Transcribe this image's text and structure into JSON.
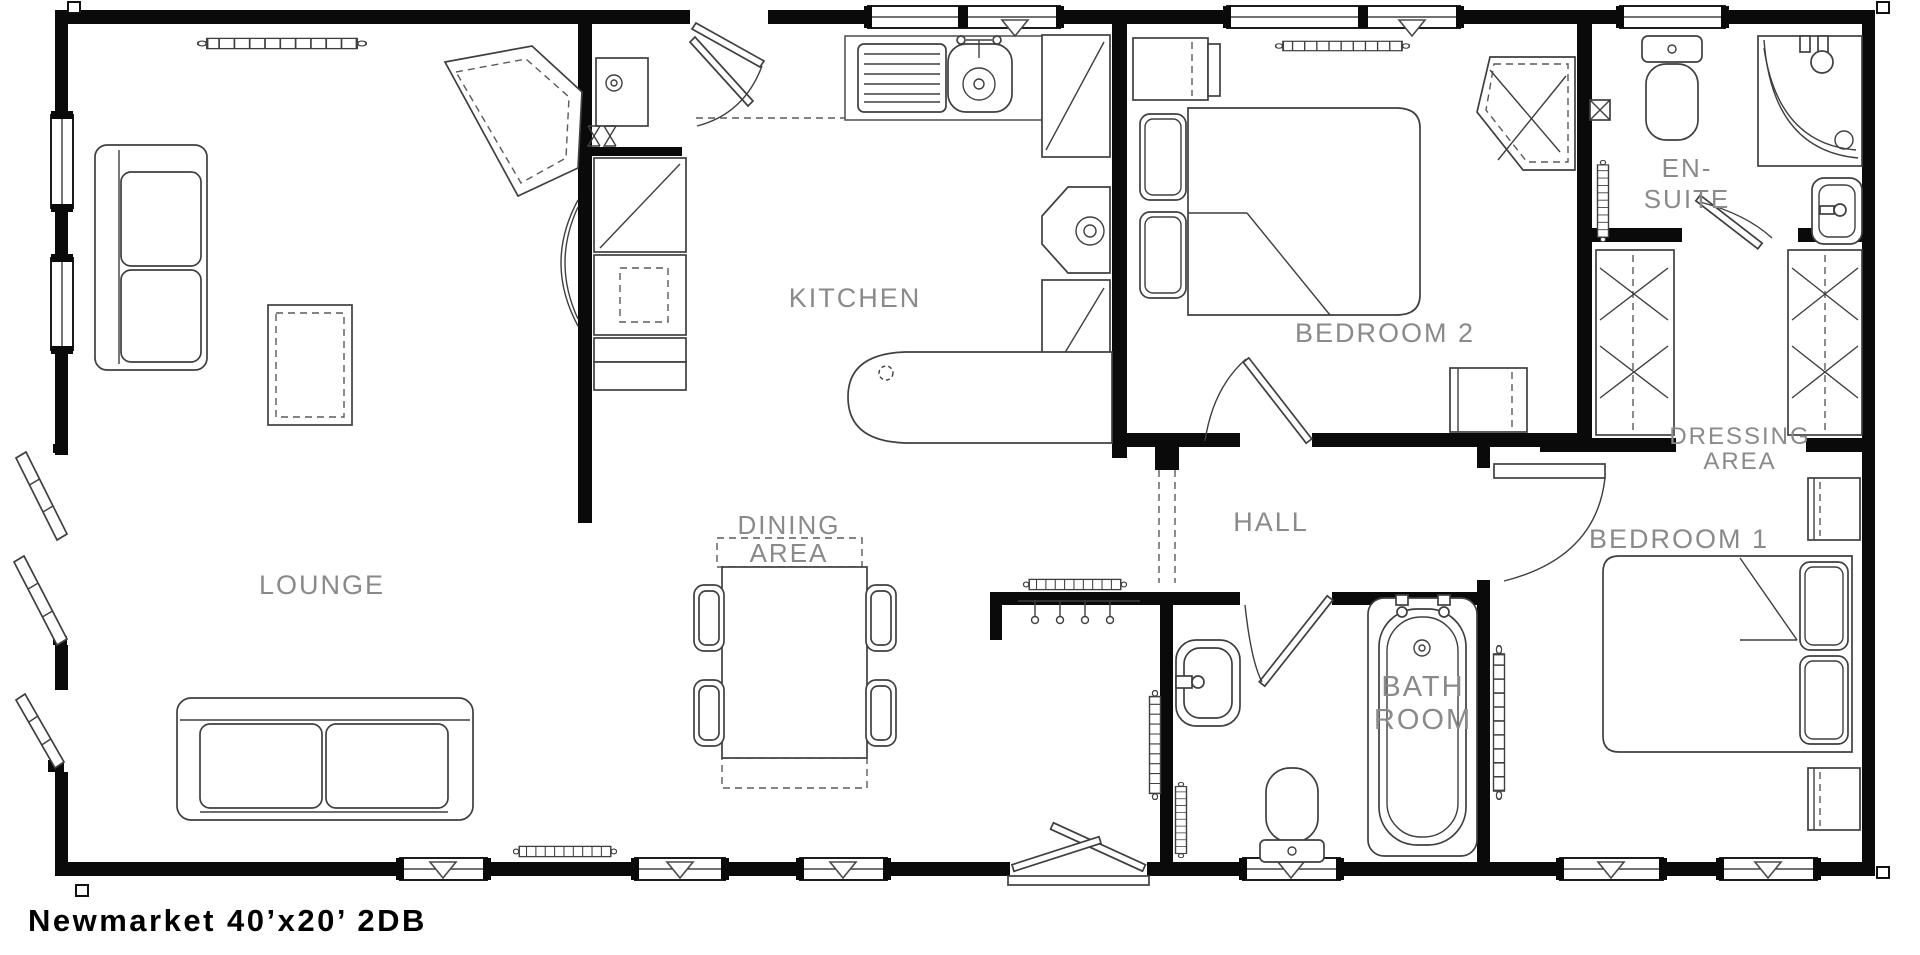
{
  "title": "Newmarket 40’x20’ 2DB",
  "colors": {
    "wall": "#0a0a0a",
    "room_label": "#8a8a8a",
    "furniture_line": "#3f3f3f",
    "background": "#ffffff"
  },
  "plan": {
    "rooms": [
      {
        "id": "lounge",
        "lines": [
          "LOUNGE"
        ],
        "x": 322,
        "y": 594,
        "size": 27,
        "lh": 28
      },
      {
        "id": "kitchen",
        "lines": [
          "KITCHEN"
        ],
        "x": 855,
        "y": 307,
        "size": 27,
        "lh": 28
      },
      {
        "id": "dining-area",
        "lines": [
          "DINING",
          "AREA"
        ],
        "x": 789,
        "y": 534,
        "size": 26,
        "lh": 28
      },
      {
        "id": "hall",
        "lines": [
          "HALL"
        ],
        "x": 1271,
        "y": 531,
        "size": 27,
        "lh": 28
      },
      {
        "id": "bedroom-2",
        "lines": [
          "BEDROOM 2"
        ],
        "x": 1385,
        "y": 342,
        "size": 27,
        "lh": 28
      },
      {
        "id": "bedroom-1",
        "lines": [
          "BEDROOM 1"
        ],
        "x": 1679,
        "y": 548,
        "size": 27,
        "lh": 28
      },
      {
        "id": "dressing-area",
        "lines": [
          "DRESSING",
          "AREA"
        ],
        "x": 1740,
        "y": 444,
        "size": 24,
        "lh": 25
      },
      {
        "id": "en-suite",
        "lines": [
          "EN-",
          "SUITE"
        ],
        "x": 1687,
        "y": 177,
        "size": 26,
        "lh": 31
      },
      {
        "id": "bathroom",
        "lines": [
          "BATH",
          "ROOM"
        ],
        "x": 1423,
        "y": 696,
        "size": 29,
        "lh": 33
      }
    ]
  }
}
